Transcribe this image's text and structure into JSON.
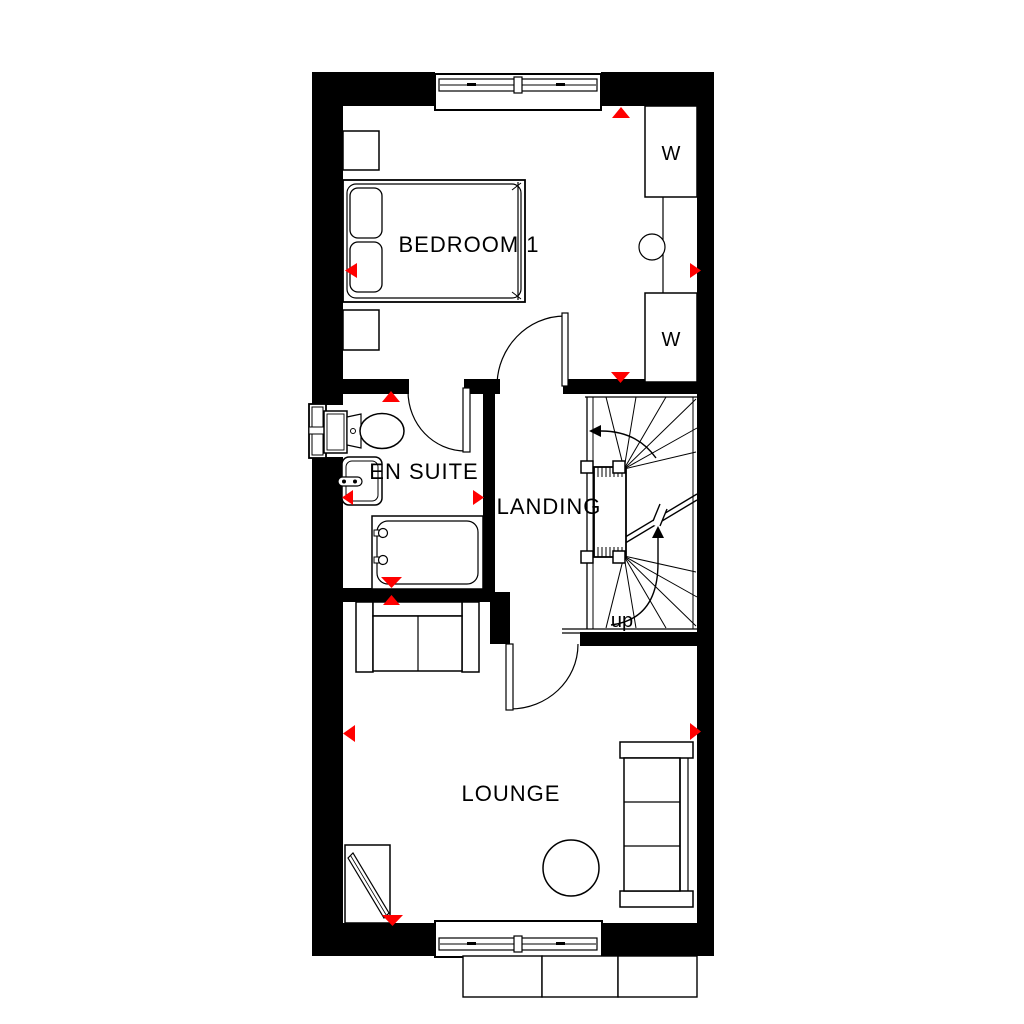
{
  "labels": {
    "bedroom1": "BEDROOM 1",
    "en_suite": "EN SUITE",
    "landing": "LANDING",
    "lounge": "LOUNGE",
    "stairs_up": "up",
    "wardrobe_top": "W",
    "wardrobe_bottom": "W"
  },
  "colors": {
    "walls": "#000000",
    "lines": "#000000",
    "direction_marker": "#ff0000",
    "background": "#ffffff"
  },
  "icons": {
    "direction_marker": "red-triangle",
    "door_swing": "quarter-arc",
    "stair_direction": "arrow-curved"
  }
}
